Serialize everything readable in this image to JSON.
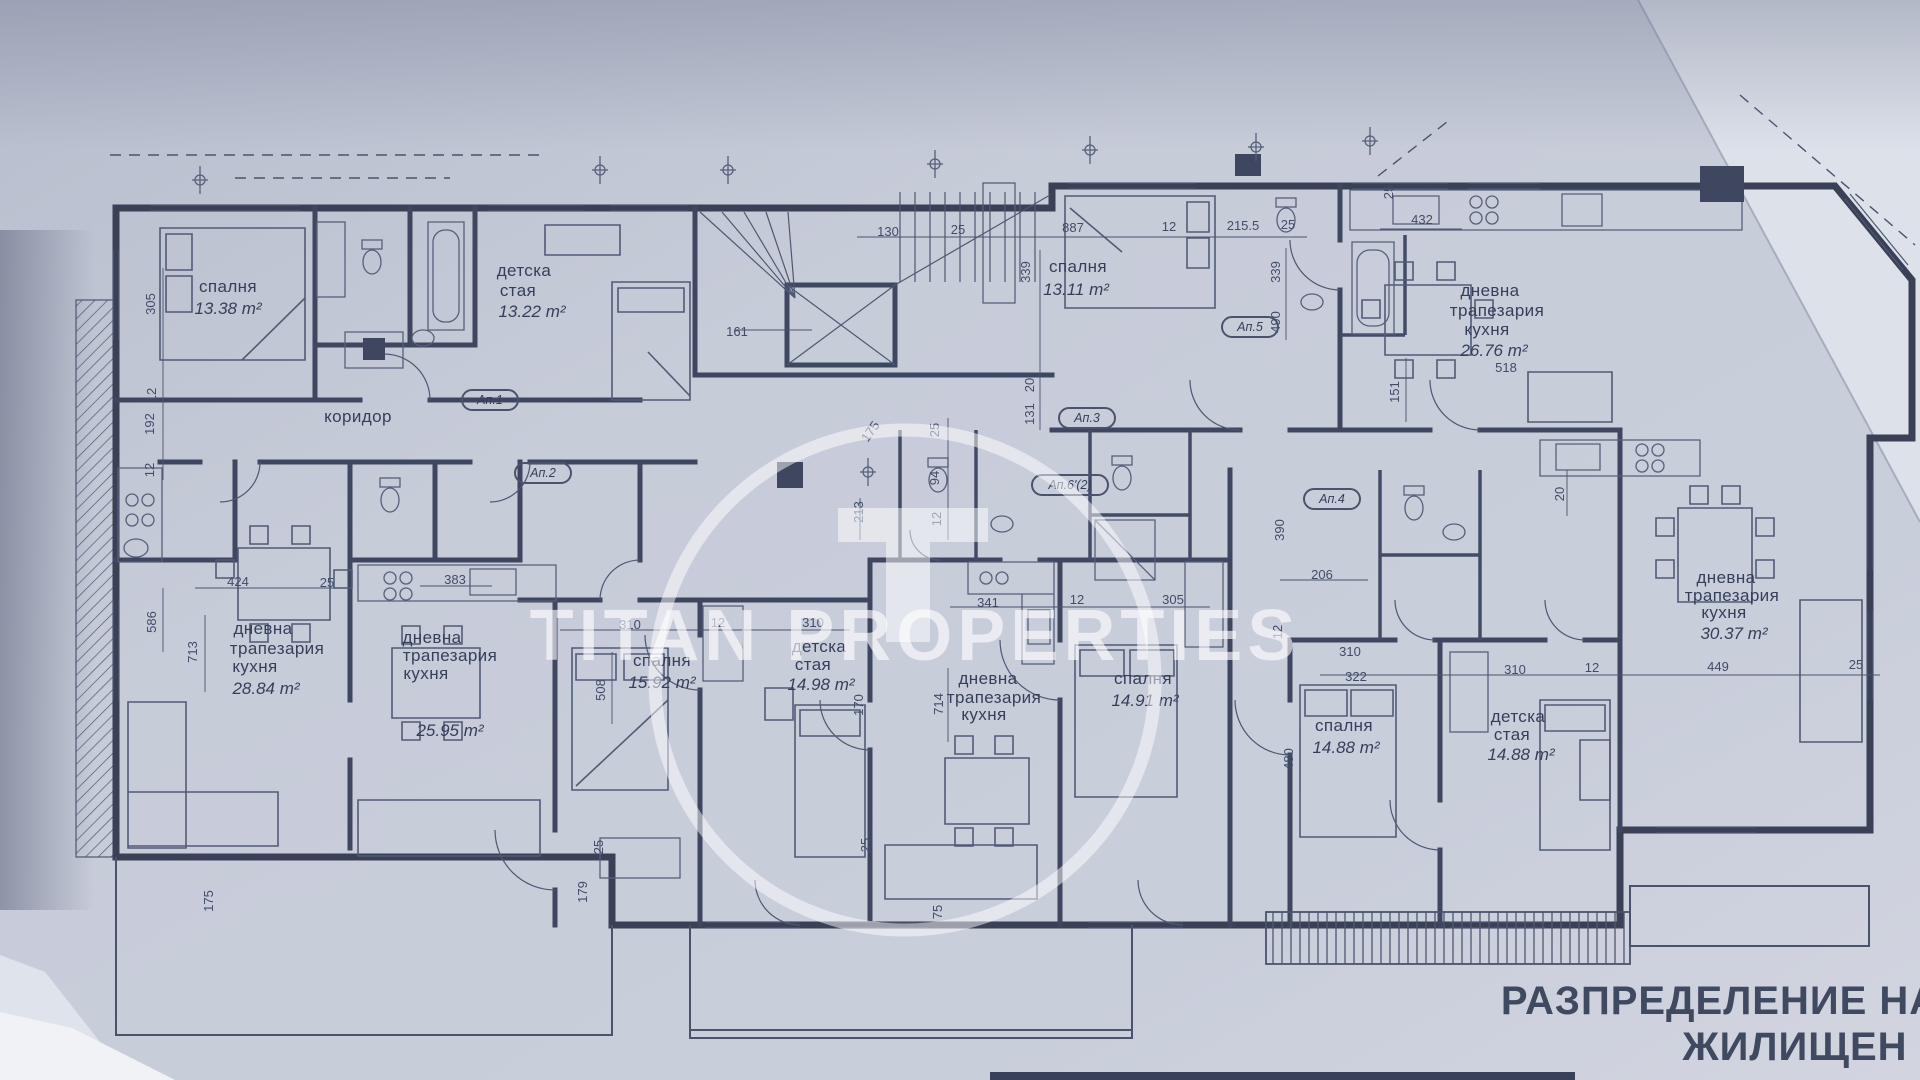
{
  "title": {
    "line1": "РАЗПРЕДЕЛЕНИЕ НА",
    "line2": "ЖИЛИЩЕН"
  },
  "watermark": {
    "brand": "TITAN PROPERTIES"
  },
  "apartments": {
    "a1": "Ап.1",
    "a2": "Ап.2",
    "a3": "Ап.3",
    "a4": "Ап.4",
    "a5": "Ап.5",
    "a6": "Ап.6'(2)"
  },
  "rooms": {
    "bedroom_nw": {
      "name": "спалня",
      "area": "13.38 m²"
    },
    "kids_nw": {
      "name1": "детска",
      "name2": "стая",
      "area": "13.22 m²"
    },
    "bedroom_n": {
      "name": "спалня",
      "area": "13.11 m²"
    },
    "living_ne": {
      "name1": "дневна",
      "name2": "трапезария",
      "name3": "кухня",
      "area": "26.76 m²",
      "note": "518"
    },
    "corridor": {
      "name": "коридор"
    },
    "living_w": {
      "name1": "дневна",
      "name2": "трапезария",
      "name3": "кухня",
      "area": "28.84 m²"
    },
    "living_sw": {
      "name1": "дневна",
      "name2": "трапезария",
      "name3": "кухня",
      "area": "25.95 m²"
    },
    "bedroom_c": {
      "name": "спалня",
      "area": "15.92 m²"
    },
    "kids_c": {
      "name1": "детска",
      "name2": "стая",
      "area": "14.98 m²"
    },
    "living_c": {
      "name1": "дневна",
      "name2": "трапезария",
      "name3": "кухня"
    },
    "bedroom_c2": {
      "name": "спалня",
      "area": "14.91 m²"
    },
    "bedroom_e": {
      "name": "спалня",
      "area": "14.88 m²"
    },
    "kids_e": {
      "name1": "детска",
      "name2": "стая",
      "area": "14.88 m²"
    },
    "living_e": {
      "name1": "дневна",
      "name2": "трапезария",
      "name3": "кухня",
      "area": "30.37 m²"
    }
  },
  "dims": {
    "d01": "130",
    "d02": "25",
    "d03": "887",
    "d04": "12",
    "d05": "215.5",
    "d06": "25",
    "d07": "432",
    "d08": "161",
    "d09": "339",
    "d10": "20",
    "d11": "131",
    "d12": "339",
    "d13": "490",
    "d14": "151",
    "d15": "25",
    "d16": "305",
    "d17": "12",
    "d18": "192",
    "d19": "12",
    "d20": "424",
    "d21": "25",
    "d22": "586",
    "d23": "713",
    "d24": "383",
    "d25": "310",
    "d26": "12",
    "d27": "310",
    "d28": "508",
    "d29": "213",
    "d30": "25",
    "d31": "94",
    "d32": "12",
    "d33": "175",
    "d34": "170",
    "d35": "714",
    "d36": "341",
    "d37": "12",
    "d38": "305",
    "d39": "206",
    "d40": "12",
    "d41": "310",
    "d42": "322",
    "d43": "310",
    "d44": "12",
    "d45": "449",
    "d46": "25",
    "d47": "480",
    "d48": "175",
    "d49": "179",
    "d50": "25",
    "d51": "25",
    "d52": "75",
    "d53": "20",
    "d54": "390"
  }
}
